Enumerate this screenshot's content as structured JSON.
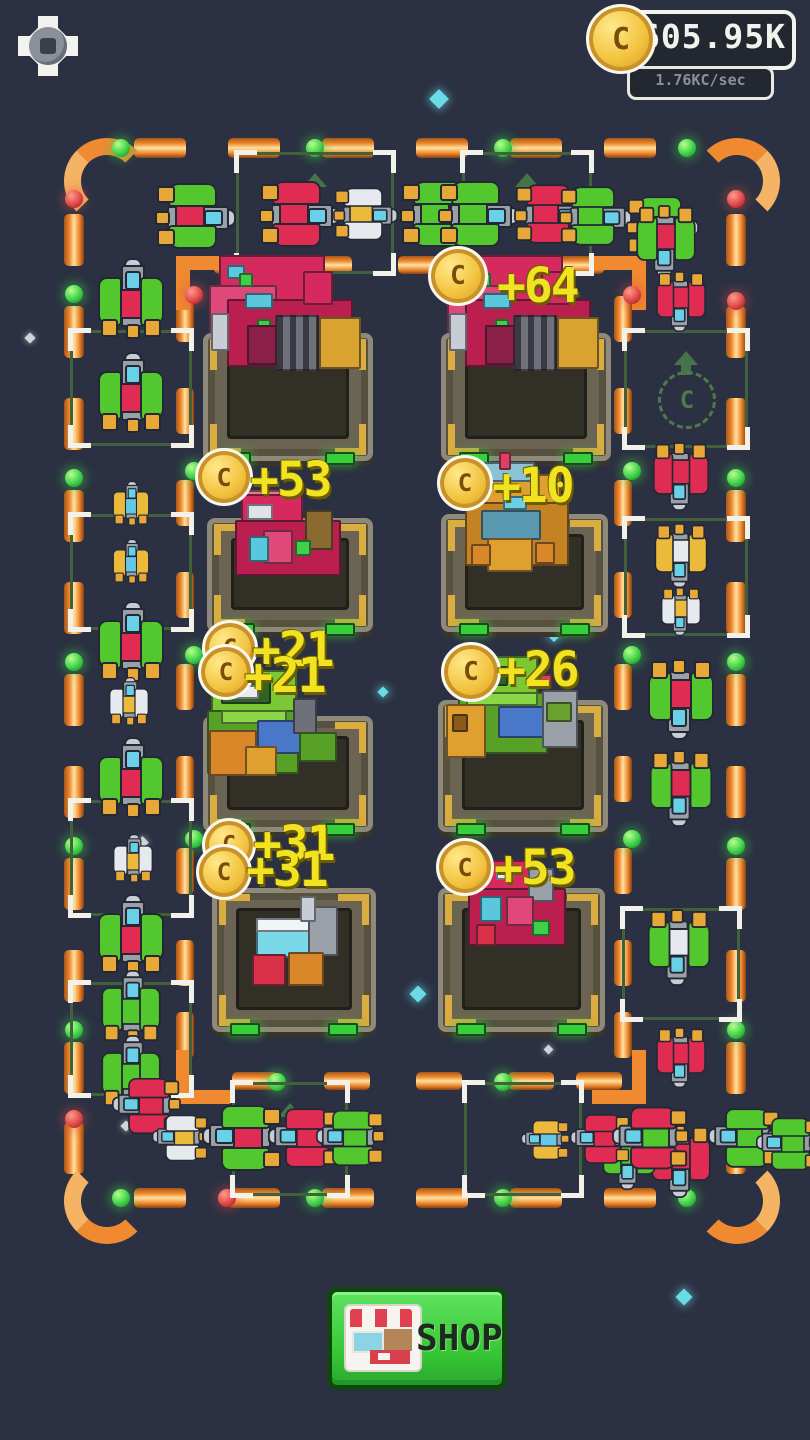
{
  "hud": {
    "settings_icon": "gear-icon",
    "coin_icon": "coin-icon",
    "coin_symbol": "C",
    "coin_balance": "605.95K",
    "income_rate": "1.76KC/sec"
  },
  "colors": {
    "background": "#2b3142",
    "track_orange": "#ef8a30",
    "track_cream": "#ffe2a1",
    "light_green": "#3ed04a",
    "light_red": "#e04848",
    "popup_yellow": "#f2e322",
    "coin_gold": "#f2c23e",
    "slot_green": "#41603c",
    "shop_green": "#35c435"
  },
  "board": {
    "coin_popups": [
      {
        "value": "+64",
        "x": 497,
        "y": 258,
        "coins": [
          {
            "x": 428,
            "y": 246,
            "s": 54
          }
        ]
      },
      {
        "value": "+53",
        "x": 250,
        "y": 452,
        "coins": [
          {
            "x": 195,
            "y": 448,
            "s": 52
          }
        ]
      },
      {
        "value": "+10",
        "x": 492,
        "y": 458,
        "coins": [
          {
            "x": 437,
            "y": 455,
            "s": 50
          }
        ]
      },
      {
        "value": "+21",
        "x": 252,
        "y": 622,
        "coins": [
          {
            "x": 202,
            "y": 620,
            "s": 50
          }
        ]
      },
      {
        "value": "+21",
        "x": 244,
        "y": 648,
        "coins": [
          {
            "x": 198,
            "y": 644,
            "s": 50
          }
        ]
      },
      {
        "value": "+26",
        "x": 497,
        "y": 642,
        "coins": [
          {
            "x": 441,
            "y": 642,
            "s": 54
          }
        ]
      },
      {
        "value": "+31",
        "x": 253,
        "y": 816,
        "coins": [
          {
            "x": 202,
            "y": 818,
            "s": 48
          }
        ]
      },
      {
        "value": "+31",
        "x": 246,
        "y": 842,
        "coins": [
          {
            "x": 196,
            "y": 844,
            "s": 50
          }
        ]
      },
      {
        "value": "+53",
        "x": 494,
        "y": 840,
        "coins": [
          {
            "x": 436,
            "y": 838,
            "s": 52
          }
        ]
      }
    ],
    "empty_slot_hint": {
      "icon_letter": "C",
      "arrow": "up-arrow-icon"
    },
    "factories": [
      {
        "x": 203,
        "y": 333,
        "w": 170,
        "h": 128,
        "variant": "red_large"
      },
      {
        "x": 441,
        "y": 333,
        "w": 170,
        "h": 128,
        "variant": "red_large"
      },
      {
        "x": 207,
        "y": 518,
        "w": 166,
        "h": 114,
        "variant": "red_med"
      },
      {
        "x": 441,
        "y": 514,
        "w": 167,
        "h": 118,
        "variant": "gold"
      },
      {
        "x": 203,
        "y": 716,
        "w": 170,
        "h": 116,
        "variant": "green_left"
      },
      {
        "x": 438,
        "y": 700,
        "w": 170,
        "h": 132,
        "variant": "green_right"
      },
      {
        "x": 212,
        "y": 888,
        "w": 164,
        "h": 144,
        "variant": "small_misc"
      },
      {
        "x": 438,
        "y": 888,
        "w": 167,
        "h": 144,
        "variant": "red_bottom"
      }
    ],
    "slots": [
      {
        "x": 236,
        "y": 152,
        "w": 152,
        "h": 116,
        "arrow": true
      },
      {
        "x": 462,
        "y": 152,
        "w": 124,
        "h": 116,
        "arrow": true
      },
      {
        "x": 70,
        "y": 330,
        "w": 116,
        "h": 110
      },
      {
        "x": 70,
        "y": 514,
        "w": 116,
        "h": 110
      },
      {
        "x": 70,
        "y": 800,
        "w": 116,
        "h": 110
      },
      {
        "x": 70,
        "y": 982,
        "w": 116,
        "h": 108
      },
      {
        "x": 624,
        "y": 330,
        "w": 118,
        "h": 112,
        "hint": true
      },
      {
        "x": 624,
        "y": 518,
        "w": 118,
        "h": 112
      },
      {
        "x": 622,
        "y": 908,
        "w": 112,
        "h": 106
      },
      {
        "x": 232,
        "y": 1082,
        "w": 110,
        "h": 108,
        "arrow": true
      },
      {
        "x": 464,
        "y": 1082,
        "w": 112,
        "h": 108
      }
    ],
    "ships": [
      {
        "x": 196,
        "y": 216,
        "r": 90,
        "wing": "green",
        "core": "red"
      },
      {
        "x": 300,
        "y": 214,
        "r": 90,
        "wing": "red",
        "core": "red"
      },
      {
        "x": 366,
        "y": 214,
        "r": 90,
        "wing": "white",
        "core": "yellow",
        "s": 0.8
      },
      {
        "x": 441,
        "y": 214,
        "r": 90,
        "wing": "green",
        "core": "green"
      },
      {
        "x": 479,
        "y": 214,
        "r": 90,
        "wing": "green",
        "core": "green"
      },
      {
        "x": 551,
        "y": 214,
        "r": 90,
        "wing": "red",
        "core": "red",
        "s": 0.9
      },
      {
        "x": 596,
        "y": 216,
        "r": 90,
        "wing": "green",
        "core": "green",
        "s": 0.9
      },
      {
        "x": 663,
        "y": 226,
        "r": 90,
        "wing": "green",
        "core": "red",
        "s": 0.9
      },
      {
        "x": 131,
        "y": 298,
        "r": 0,
        "wing": "green",
        "core": "red"
      },
      {
        "x": 131,
        "y": 392,
        "r": 0,
        "wing": "green",
        "core": "red"
      },
      {
        "x": 131,
        "y": 503,
        "r": 0,
        "wing": "yellow",
        "core": "blue",
        "s": 0.55
      },
      {
        "x": 131,
        "y": 561,
        "r": 0,
        "wing": "yellow",
        "core": "blue",
        "s": 0.55
      },
      {
        "x": 131,
        "y": 641,
        "r": 0,
        "wing": "green",
        "core": "red"
      },
      {
        "x": 129,
        "y": 701,
        "r": 0,
        "wing": "white",
        "core": "yellow",
        "s": 0.6
      },
      {
        "x": 131,
        "y": 777,
        "r": 0,
        "wing": "green",
        "core": "red"
      },
      {
        "x": 133,
        "y": 858,
        "r": 0,
        "wing": "white",
        "core": "yellow",
        "s": 0.6
      },
      {
        "x": 131,
        "y": 934,
        "r": 0,
        "wing": "green",
        "core": "red"
      },
      {
        "x": 131,
        "y": 1006,
        "r": 0,
        "wing": "green",
        "core": "green",
        "s": 0.9
      },
      {
        "x": 131,
        "y": 1071,
        "r": 0,
        "wing": "green",
        "core": "green",
        "s": 0.9
      },
      {
        "x": 666,
        "y": 242,
        "r": 180,
        "wing": "green",
        "core": "red",
        "s": 0.9
      },
      {
        "x": 681,
        "y": 302,
        "r": 180,
        "wing": "red",
        "core": "red",
        "s": 0.75
      },
      {
        "x": 681,
        "y": 477,
        "r": 180,
        "wing": "red",
        "core": "red",
        "s": 0.85
      },
      {
        "x": 681,
        "y": 556,
        "r": 180,
        "wing": "yellow",
        "core": "white",
        "s": 0.8
      },
      {
        "x": 681,
        "y": 612,
        "r": 180,
        "wing": "white",
        "core": "yellow",
        "s": 0.6
      },
      {
        "x": 681,
        "y": 700,
        "r": 180,
        "wing": "green",
        "core": "red"
      },
      {
        "x": 681,
        "y": 789,
        "r": 180,
        "wing": "green",
        "core": "red",
        "s": 0.95
      },
      {
        "x": 679,
        "y": 948,
        "r": 180,
        "wing": "green",
        "core": "white",
        "s": 0.95
      },
      {
        "x": 681,
        "y": 1058,
        "r": 180,
        "wing": "red",
        "core": "red",
        "s": 0.75
      },
      {
        "x": 681,
        "y": 1162,
        "r": 180,
        "wing": "red",
        "core": "red",
        "s": 0.9
      },
      {
        "x": 629,
        "y": 1158,
        "r": 180,
        "wing": "green",
        "core": "green",
        "s": 0.8
      },
      {
        "x": 146,
        "y": 1106,
        "r": 270,
        "wing": "red",
        "core": "red",
        "s": 0.85
      },
      {
        "x": 180,
        "y": 1138,
        "r": 270,
        "wing": "white",
        "core": "yellow",
        "s": 0.7
      },
      {
        "x": 242,
        "y": 1138,
        "r": 270,
        "wing": "green",
        "core": "red"
      },
      {
        "x": 304,
        "y": 1138,
        "r": 270,
        "wing": "red",
        "core": "red",
        "s": 0.9
      },
      {
        "x": 350,
        "y": 1138,
        "r": 270,
        "wing": "green",
        "core": "green",
        "s": 0.85
      },
      {
        "x": 545,
        "y": 1140,
        "r": 270,
        "wing": "yellow",
        "core": "blue",
        "s": 0.6
      },
      {
        "x": 600,
        "y": 1139,
        "r": 270,
        "wing": "red",
        "core": "red",
        "s": 0.75
      },
      {
        "x": 650,
        "y": 1138,
        "r": 270,
        "wing": "red",
        "core": "green",
        "s": 0.95
      },
      {
        "x": 744,
        "y": 1138,
        "r": 270,
        "wing": "green",
        "core": "green",
        "s": 0.9
      },
      {
        "x": 788,
        "y": 1144,
        "r": 270,
        "wing": "green",
        "core": "green",
        "s": 0.8
      }
    ],
    "stars": [
      {
        "x": 432,
        "y": 92,
        "c": "cyan",
        "s": 14
      },
      {
        "x": 549,
        "y": 630,
        "c": "cyan",
        "s": 10
      },
      {
        "x": 379,
        "y": 688,
        "c": "cyan",
        "s": 8
      },
      {
        "x": 412,
        "y": 988,
        "c": "cyan",
        "s": 12
      },
      {
        "x": 678,
        "y": 1291,
        "c": "cyan",
        "s": 12
      },
      {
        "x": 122,
        "y": 1122,
        "c": "white",
        "s": 8
      },
      {
        "x": 545,
        "y": 1046,
        "c": "white",
        "s": 7
      },
      {
        "x": 138,
        "y": 838,
        "c": "white",
        "s": 9
      },
      {
        "x": 26,
        "y": 334,
        "c": "white",
        "s": 8
      }
    ]
  },
  "shop": {
    "label": "SHOP",
    "icon": "storefront-icon"
  }
}
